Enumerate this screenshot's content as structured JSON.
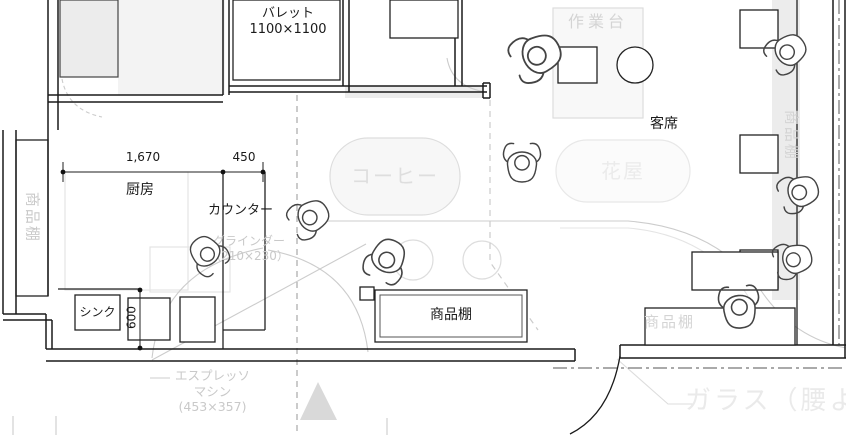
{
  "plan": {
    "labels": {
      "pallet_name": "バレット",
      "pallet_size": "1100×1100",
      "work_table": "作業台",
      "seating": "客席",
      "coffee_table": "コーヒー",
      "flower_table": "花屋",
      "kitchen": "厨房",
      "counter": "カウンター",
      "grinder_name": "グラインダー",
      "grinder_size": "（210×230）",
      "sink": "シンク",
      "shelf_left": "商品棚",
      "shelf_bottom": "商品棚",
      "shelf_right": "商品棚",
      "shelf_bottom_right": "商品棚",
      "espresso_name": "エスプレッソ",
      "espresso_name2": "マシン",
      "espresso_size": "(453×357)",
      "glass_wall": "ガラス（腰より",
      "dim_width_main": "1,670",
      "dim_width_counter": "450",
      "dim_depth_sink": "600"
    },
    "colors": {
      "wall": "#1a1a1a",
      "annotation_gray": "#c9c9c9",
      "annotation_faint": "#e6e6e6",
      "fill_light": "#efefef"
    }
  }
}
